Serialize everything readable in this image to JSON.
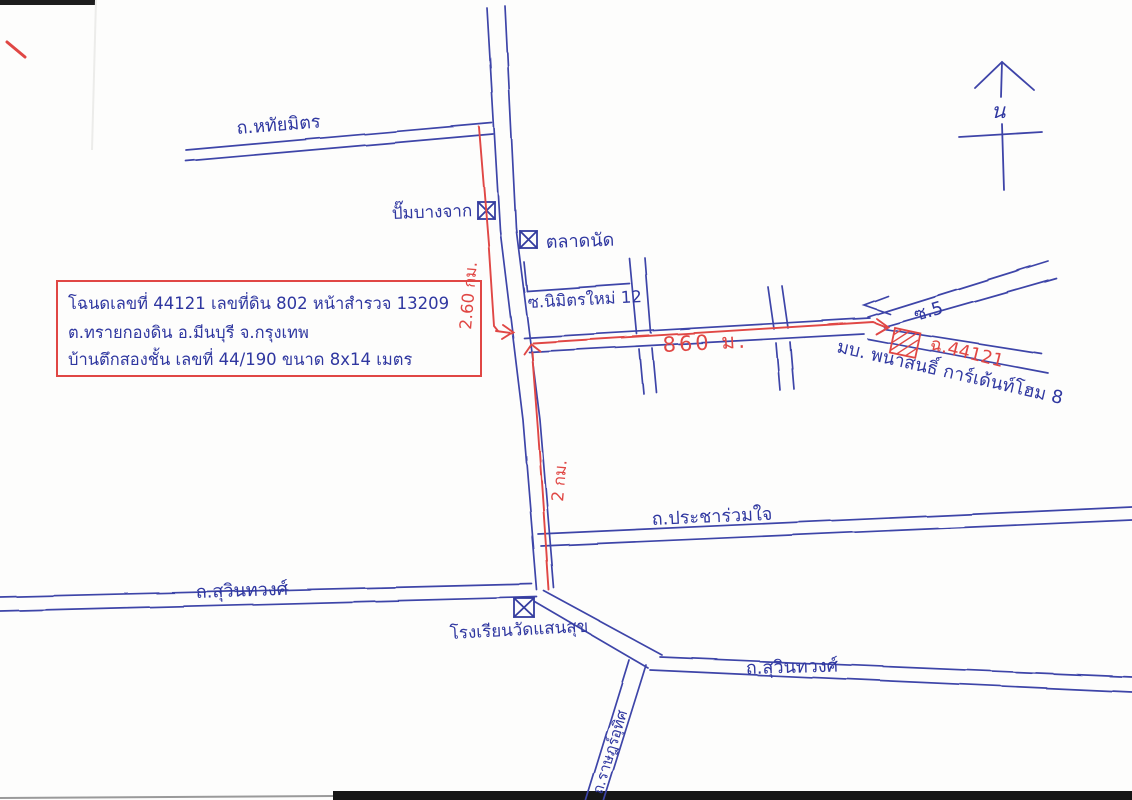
{
  "info_box": {
    "line1": "โฉนดเลขที่ 44121 เลขที่ดิน 802 หน้าสำรวจ 13209",
    "line2": "ต.ทรายกองดิน  อ.มีนบุรี  จ.กรุงเทพ",
    "line3": "บ้านตึกสองชั้น เลขที่ 44/190 ขนาด 8x14 เมตร"
  },
  "roads": {
    "hathai_mit": "ถ.หทัยมิตร",
    "nimit_mai_12": "ซ.นิมิตรใหม่ 12",
    "soi_5": "ซ.5",
    "pracha_ruam_jai": "ถ.ประชาร่วมใจ",
    "suwinthawong_west": "ถ.สุวินทวงศ์",
    "suwinthawong_east": "ถ.สุวินทวงศ์",
    "rat_uthit": "ถ.ราษฎร์อุทิศ"
  },
  "landmarks": {
    "gas_station": "ปั๊มบางจาก",
    "market": "ตลาดนัด",
    "school": "โรงเรียนวัดแสนสุข",
    "village": "มบ. พนาสนธิ์ การ์เด้นท์โฮม 8",
    "deed_marker": "ฉ.44121"
  },
  "route": {
    "distance_north": "2.60 กม.",
    "distance_south": "2 กม.",
    "distance_east": "860 ม."
  },
  "compass": {
    "north": "น"
  },
  "colors": {
    "pen_blue": "#3a41a6",
    "pen_red": "#e04744"
  }
}
